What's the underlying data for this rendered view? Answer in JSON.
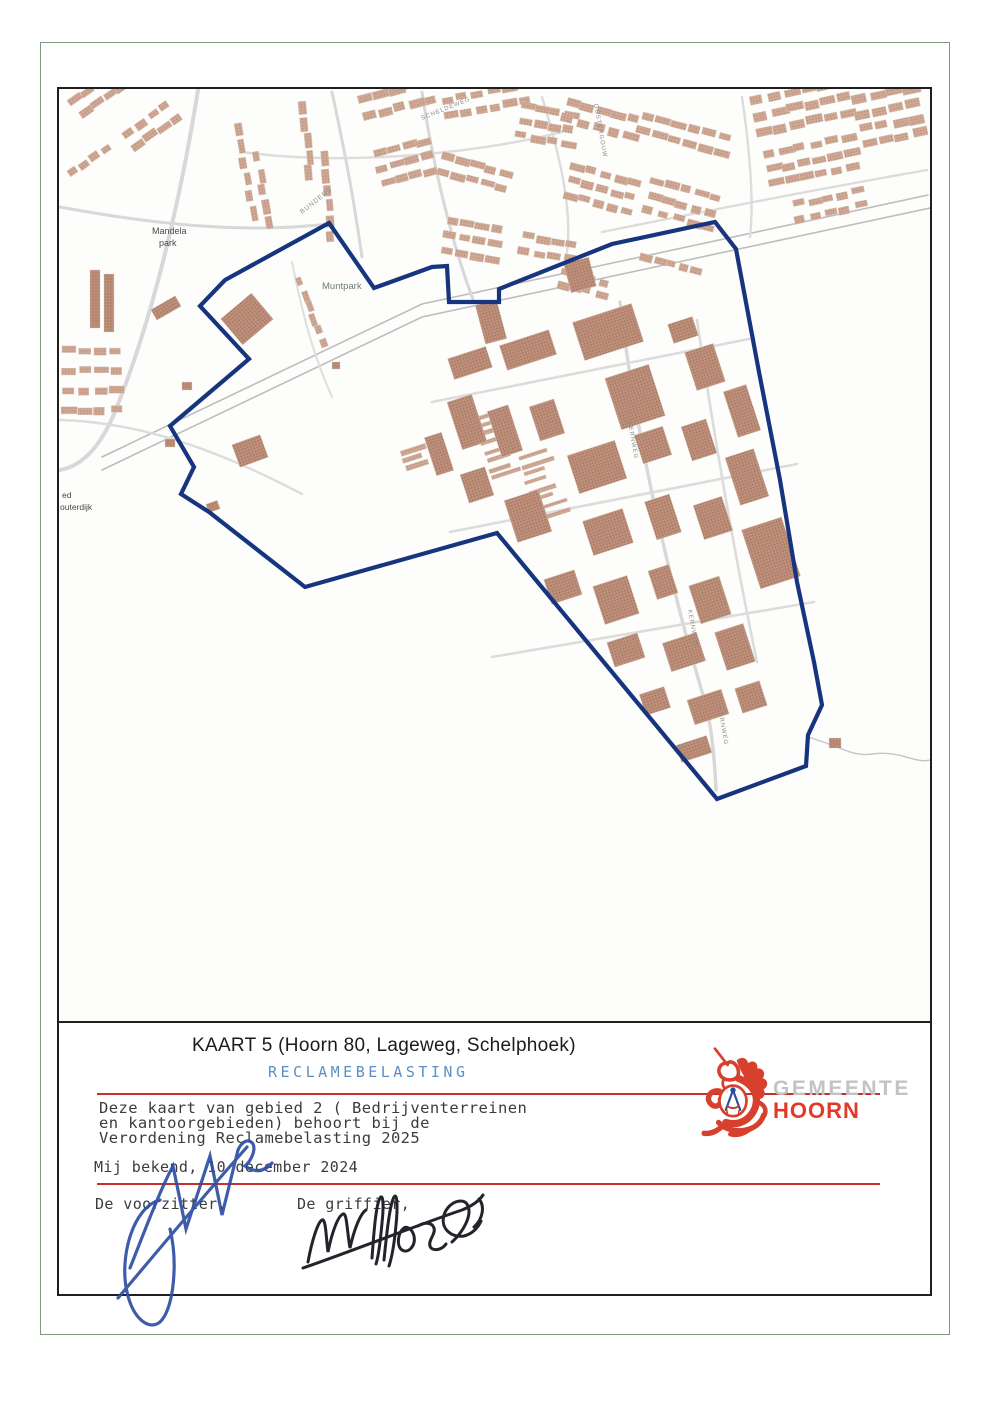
{
  "doc": {
    "title_line": "KAART 5 (Hoorn 80, Lageweg, Schelphoek)",
    "subtitle": "RECLAMEBELASTING",
    "paragraph": "Deze kaart van gebied 2 ( Bedrijventerreinen\nen kantoorgebieden) behoort bij de\nVerordening Reclamebelasting 2025",
    "known_line": "Mij bekend, 10 december 2024",
    "chairman_label": "De voorzitter,",
    "clerk_label": "De griffier,"
  },
  "logo": {
    "org_top": "GEMEENTE",
    "org_bottom": "HOORN"
  },
  "colors": {
    "boundary_blue": "#17357e",
    "red_line": "#c9302c",
    "subtitle_blue": "#5d8fc2",
    "logo_red": "#d6402c",
    "logo_gray": "#c3c3c3",
    "building_light": "#cfa793",
    "building_dark": "#bd8f7a",
    "signature_blue": "#2e4fa3",
    "signature_black": "#23242b"
  },
  "map": {
    "labels": {
      "park1_line1": "Mandela",
      "park1_line2": "park",
      "park2": "Muntpark",
      "street_bunders": "BUNDERS",
      "street_scheldeweg": "SCHELDEWEG",
      "street_oostergouw": "OOSTERGOUW",
      "street_kernweg1": "KERNWEG",
      "street_kernweg2": "KERNWEG",
      "street_kernweg3": "KERNWEG",
      "edge_label_line1": "ed",
      "edge_label_line2": "outerdijk"
    },
    "boundary_points": "327,221 372,286 430,265 445,264 447,300 497,300 497,287 610,242 713,220 734,247 757,370 778,478 795,580 812,660 820,703 806,733 804,764 715,797 495,531 303,585 207,510 179,492 192,465 168,424 247,357 198,304 223,278",
    "roads": [
      {
        "d": "M 100,455 L 420,302 L 926,193",
        "w": 1.6,
        "c": "#bdbdbd"
      },
      {
        "d": "M 100,468 L 420,315 L 928,206",
        "w": 1.6,
        "c": "#bdbdbd"
      },
      {
        "d": "M 196,88 C 178,200 150,320 112,412 C 95,452 75,465 58,468",
        "w": 4,
        "c": "#d8d8d8"
      },
      {
        "d": "M 58,205 C 150,222 240,232 327,222",
        "w": 3,
        "c": "#d8d8d8"
      },
      {
        "d": "M 330,90 C 345,160 352,200 360,255",
        "w": 3,
        "c": "#d8d8d8"
      },
      {
        "d": "M 420,90 C 432,170 452,248 472,300",
        "w": 3,
        "c": "#d8d8d8"
      },
      {
        "d": "M 240,150 C 350,165 480,150 560,130",
        "w": 2.4,
        "c": "#dcdcdc"
      },
      {
        "d": "M 600,230 C 700,210 800,190 925,168",
        "w": 2.4,
        "c": "#dcdcdc"
      },
      {
        "d": "M 618,300 C 632,420 662,560 700,690 C 708,712 712,745 714,788",
        "w": 3.4,
        "c": "#d8d8d8"
      },
      {
        "d": "M 430,400 L 752,336",
        "w": 2.6,
        "c": "#dcdcdc"
      },
      {
        "d": "M 448,530 L 795,462",
        "w": 2.6,
        "c": "#dcdcdc"
      },
      {
        "d": "M 490,655 L 812,600",
        "w": 2.6,
        "c": "#dcdcdc"
      },
      {
        "d": "M 695,318 C 710,420 730,540 755,660",
        "w": 2.6,
        "c": "#dcdcdc"
      },
      {
        "d": "M 290,260 C 300,310 310,350 330,395",
        "w": 2,
        "c": "#dedede"
      },
      {
        "d": "M 58,418 C 140,420 220,450 300,492",
        "w": 2.4,
        "c": "#dcdcdc"
      },
      {
        "d": "M 806,735 C 840,745 850,755 870,752 C 900,748 912,762 928,758",
        "w": 1.4,
        "c": "#c4c4c4"
      },
      {
        "d": "M 540,95 C 560,160 570,210 565,250",
        "w": 2.4,
        "c": "#dcdcdc"
      },
      {
        "d": "M 740,95 C 748,150 752,200 748,235",
        "w": 2.4,
        "c": "#dcdcdc"
      }
    ],
    "clusters": [
      [
        66,
        98,
        -35,
        2,
        5,
        12,
        7,
        15,
        16
      ],
      [
        120,
        130,
        -35,
        2,
        4,
        12,
        7,
        15,
        16
      ],
      [
        64,
        170,
        -35,
        1,
        4,
        11,
        7,
        14,
        14
      ],
      [
        60,
        345,
        0,
        4,
        4,
        13,
        7,
        16,
        20
      ],
      [
        238,
        120,
        80,
        1,
        6,
        13,
        7,
        17,
        14
      ],
      [
        258,
        150,
        80,
        1,
        5,
        12,
        7,
        16,
        14
      ],
      [
        305,
        100,
        85,
        1,
        5,
        13,
        7,
        16,
        14
      ],
      [
        325,
        150,
        85,
        1,
        6,
        12,
        7,
        16,
        14
      ],
      [
        355,
        95,
        -15,
        2,
        5,
        13,
        8,
        16,
        17
      ],
      [
        370,
        150,
        -15,
        3,
        4,
        12,
        7,
        15,
        15
      ],
      [
        440,
        95,
        -10,
        2,
        6,
        12,
        7,
        15,
        15
      ],
      [
        440,
        150,
        15,
        2,
        5,
        12,
        7,
        15,
        16
      ],
      [
        520,
        100,
        10,
        3,
        4,
        12,
        7,
        15,
        15
      ],
      [
        565,
        95,
        15,
        2,
        5,
        13,
        8,
        16,
        17
      ],
      [
        570,
        160,
        15,
        3,
        5,
        12,
        7,
        15,
        15
      ],
      [
        640,
        110,
        15,
        2,
        6,
        13,
        7,
        16,
        15
      ],
      [
        650,
        175,
        15,
        3,
        5,
        12,
        7,
        15,
        15
      ],
      [
        748,
        95,
        -12,
        3,
        6,
        14,
        8,
        17,
        16
      ],
      [
        760,
        150,
        -12,
        3,
        6,
        13,
        7,
        16,
        15
      ],
      [
        850,
        95,
        -12,
        4,
        4,
        14,
        8,
        17,
        15
      ],
      [
        790,
        200,
        -12,
        2,
        5,
        12,
        7,
        15,
        14
      ],
      [
        445,
        215,
        10,
        3,
        4,
        12,
        7,
        15,
        15
      ],
      [
        520,
        230,
        10,
        2,
        4,
        12,
        7,
        15,
        15
      ],
      [
        560,
        265,
        15,
        2,
        4,
        10,
        7,
        13,
        14
      ],
      [
        640,
        250,
        15,
        1,
        5,
        10,
        7,
        13,
        14
      ],
      [
        300,
        275,
        70,
        1,
        6,
        10,
        6,
        13,
        14
      ],
      [
        470,
        415,
        -18,
        8,
        1,
        26,
        4,
        30,
        9
      ],
      [
        515,
        455,
        -18,
        8,
        1,
        26,
        4,
        30,
        9
      ],
      [
        398,
        448,
        -18,
        3,
        1,
        22,
        5,
        26,
        9
      ]
    ],
    "industrial": [
      [
        448,
        350,
        40,
        22
      ],
      [
        500,
        335,
        52,
        26
      ],
      [
        575,
        310,
        62,
        40
      ],
      [
        610,
        368,
        46,
        54
      ],
      [
        668,
        318,
        26,
        20
      ],
      [
        688,
        345,
        30,
        40
      ],
      [
        728,
        385,
        24,
        48
      ],
      [
        452,
        395,
        26,
        50
      ],
      [
        492,
        405,
        22,
        48
      ],
      [
        532,
        400,
        26,
        36
      ],
      [
        570,
        445,
        50,
        40
      ],
      [
        636,
        428,
        30,
        30
      ],
      [
        684,
        420,
        26,
        36
      ],
      [
        730,
        450,
        30,
        50
      ],
      [
        462,
        468,
        26,
        30
      ],
      [
        508,
        492,
        36,
        44
      ],
      [
        585,
        512,
        42,
        36
      ],
      [
        648,
        495,
        26,
        40
      ],
      [
        696,
        498,
        30,
        36
      ],
      [
        748,
        520,
        42,
        62
      ],
      [
        545,
        572,
        32,
        26
      ],
      [
        596,
        578,
        36,
        40
      ],
      [
        650,
        565,
        22,
        30
      ],
      [
        692,
        578,
        32,
        40
      ],
      [
        608,
        635,
        32,
        26
      ],
      [
        664,
        635,
        36,
        30
      ],
      [
        718,
        625,
        30,
        40
      ],
      [
        640,
        688,
        26,
        22
      ],
      [
        688,
        692,
        36,
        26
      ],
      [
        736,
        682,
        26,
        26
      ],
      [
        676,
        738,
        32,
        18
      ],
      [
        428,
        432,
        18,
        40
      ]
    ],
    "singles": [
      [
        225,
        300,
        40,
        34,
        -40
      ],
      [
        233,
        437,
        30,
        24,
        -20
      ],
      [
        163,
        437,
        10,
        8,
        0
      ],
      [
        205,
        500,
        12,
        9,
        -20
      ],
      [
        478,
        300,
        22,
        40,
        -15
      ],
      [
        565,
        258,
        26,
        30,
        -15
      ],
      [
        827,
        736,
        12,
        10,
        0
      ],
      [
        88,
        268,
        10,
        58,
        0
      ],
      [
        102,
        272,
        10,
        58,
        0
      ],
      [
        150,
        300,
        28,
        12,
        -30
      ],
      [
        180,
        380,
        10,
        8,
        0
      ],
      [
        330,
        360,
        8,
        7,
        0
      ]
    ]
  }
}
